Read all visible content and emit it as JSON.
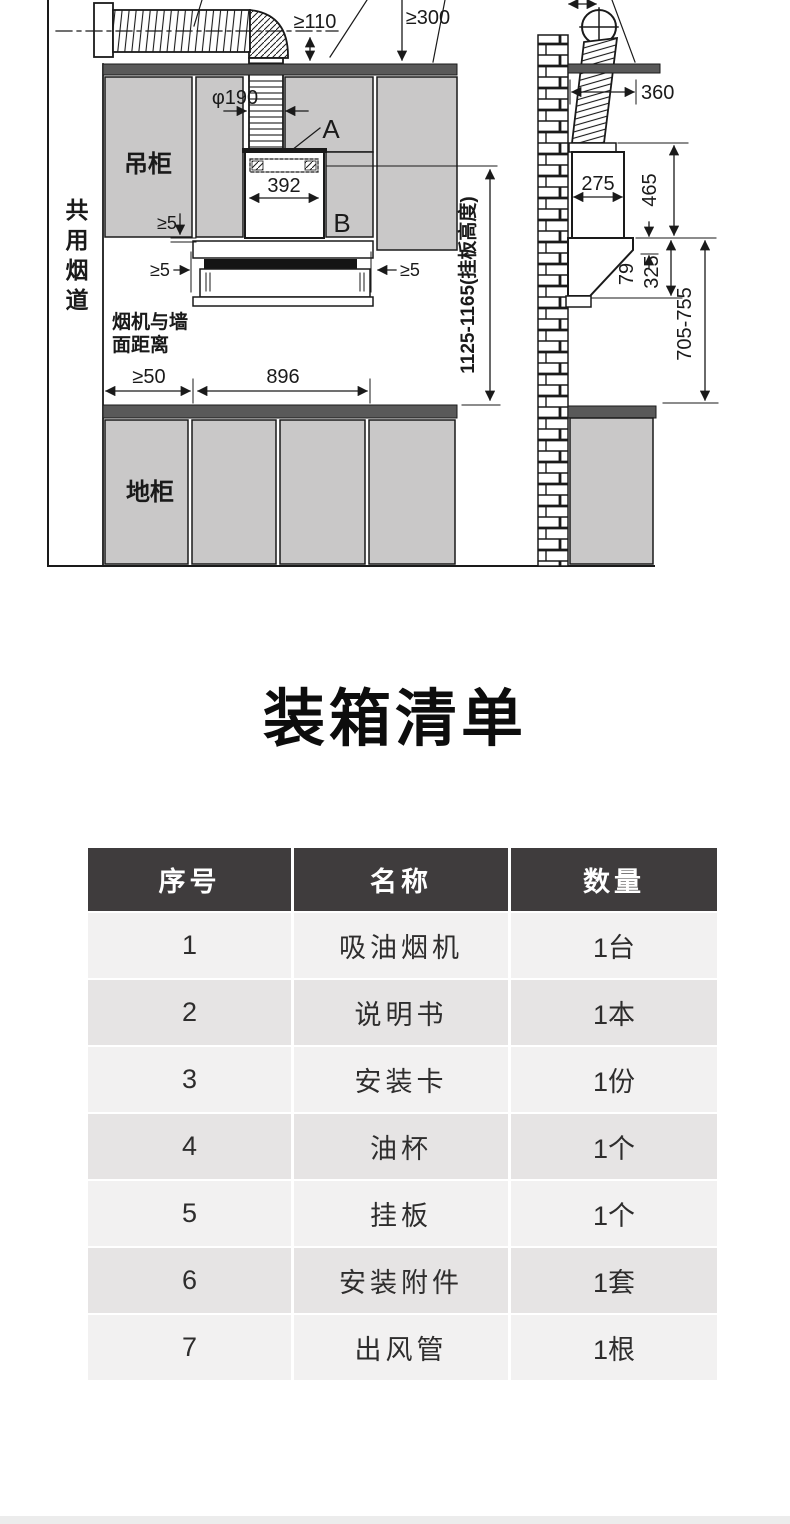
{
  "title": "装箱清单",
  "diagram": {
    "front": {
      "shared_flue_label": "共用烟道",
      "upper_cabinet_label": "吊柜",
      "base_cabinet_label": "地柜",
      "wall_distance_line1": "烟机与墙",
      "wall_distance_line2": "面距离",
      "point_a": "A",
      "point_b": "B",
      "dims": {
        "min_clearance_top": "≥110",
        "min_clearance_ceiling": "≥300",
        "duct_diameter": "φ190",
        "plate_width": "392",
        "min_gap": "≥5",
        "min_wall_gap": "≥50",
        "hood_width": "896",
        "plate_height_range": "1125-1165(挂板高度)"
      }
    },
    "side": {
      "dims": {
        "duct_offset": "360",
        "chimney_depth": "275",
        "chimney_height": "465",
        "top_thickness": "79",
        "hood_height": "325",
        "hood_to_counter": "705-755"
      }
    }
  },
  "table": {
    "columns": [
      "序号",
      "名称",
      "数量"
    ],
    "rows": [
      {
        "no": "1",
        "name": "吸油烟机",
        "qty": "1台"
      },
      {
        "no": "2",
        "name": "说明书",
        "qty": "1本"
      },
      {
        "no": "3",
        "name": "安装卡",
        "qty": "1份"
      },
      {
        "no": "4",
        "name": "油杯",
        "qty": "1个"
      },
      {
        "no": "5",
        "name": "挂板",
        "qty": "1个"
      },
      {
        "no": "6",
        "name": "安装附件",
        "qty": "1套"
      },
      {
        "no": "7",
        "name": "出风管",
        "qty": "1根"
      }
    ]
  },
  "colors": {
    "header_bg": "#3f3c3d",
    "row_light": "#f2f1f1",
    "row_dark": "#e6e4e4",
    "cabinet_gray": "#c9c8c8",
    "counter_dark": "#595959",
    "line": "#1a1a1a"
  }
}
